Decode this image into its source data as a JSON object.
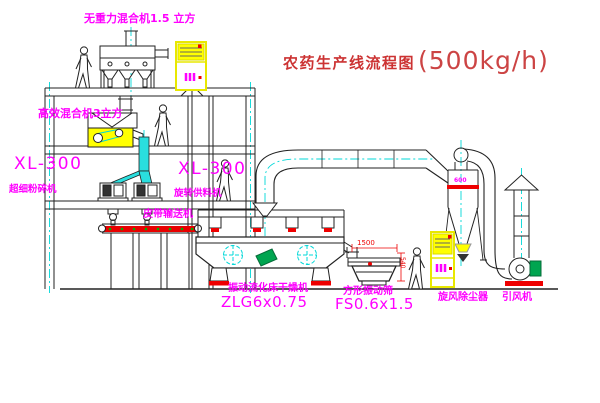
{
  "title": {
    "text": "农药生产线流程图",
    "capacity": "(500kg/h)"
  },
  "equipment_labels": {
    "gravity_mixer": "无重力混合机1.5 立方",
    "high_efficiency_mixer": "高效混合机3立方",
    "mill_left": {
      "model": "XL-300",
      "name": "超细粉碎机"
    },
    "mill_center": {
      "model": "XL-300",
      "name": "旋转供料机"
    },
    "belt_conveyor": "皮带输送机",
    "fluid_bed_dryer": {
      "name": "振动流化床干燥机",
      "model": "ZLG6x0.75"
    },
    "vibrating_screen": {
      "name": "方形振动筛",
      "model": "FS0.6x1.5"
    },
    "cyclone": "旋风除尘器",
    "induced_draft_fan": "引风机"
  },
  "dimensions": {
    "cyclone_diameter": "600",
    "screen_length": "1500",
    "screen_height": "540"
  },
  "colors": {
    "label_magenta": "#ff00ff",
    "title_red": "#cc3333",
    "line_black": "#222222",
    "centerline_cyan": "#00d8d8",
    "highlight_yellow": "#ffff00",
    "accent_red": "#ee0000",
    "machine_green": "#00a550"
  }
}
